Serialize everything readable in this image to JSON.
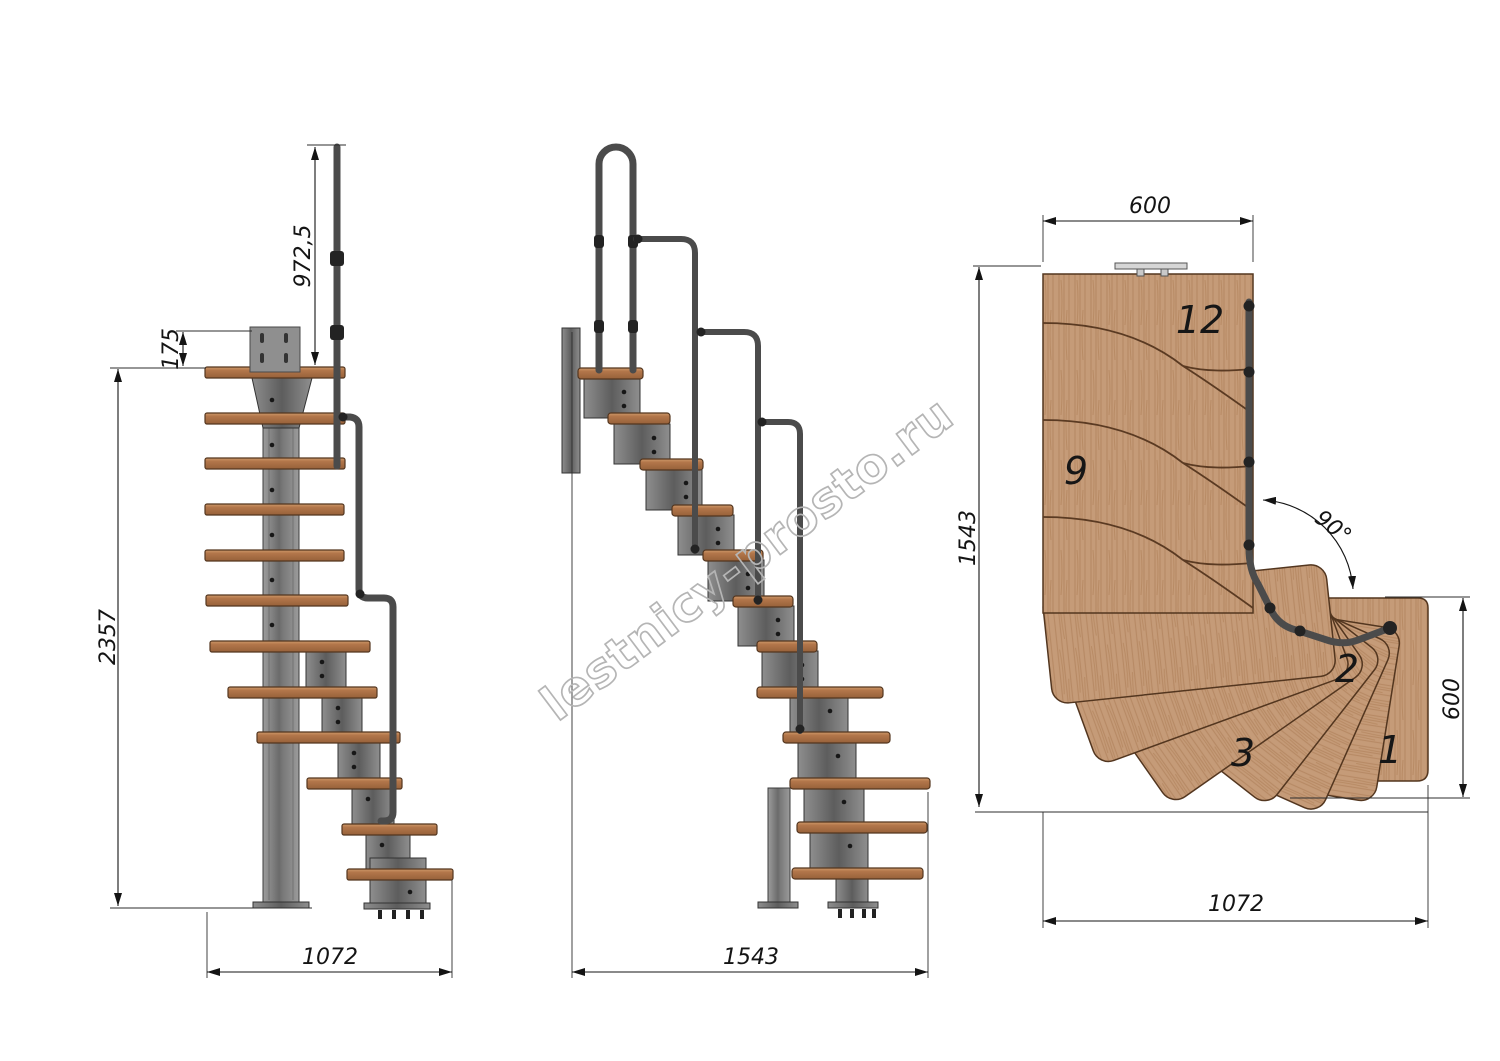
{
  "watermark": {
    "text": "lestnicy-prosto.ru"
  },
  "side_view": {
    "handrail_height": "972,5",
    "bracket_offset": "175",
    "total_height": "2357",
    "footprint_depth": "1072"
  },
  "front_view": {
    "footprint_width": "1543"
  },
  "plan_view": {
    "top_width": "600",
    "left_length": "1543",
    "turn_angle": "90°",
    "right_width": "600",
    "bottom_length": "1072",
    "steps": {
      "s12": "12",
      "s9": "9",
      "s3": "3",
      "s2": "2",
      "s1": "1"
    }
  }
}
